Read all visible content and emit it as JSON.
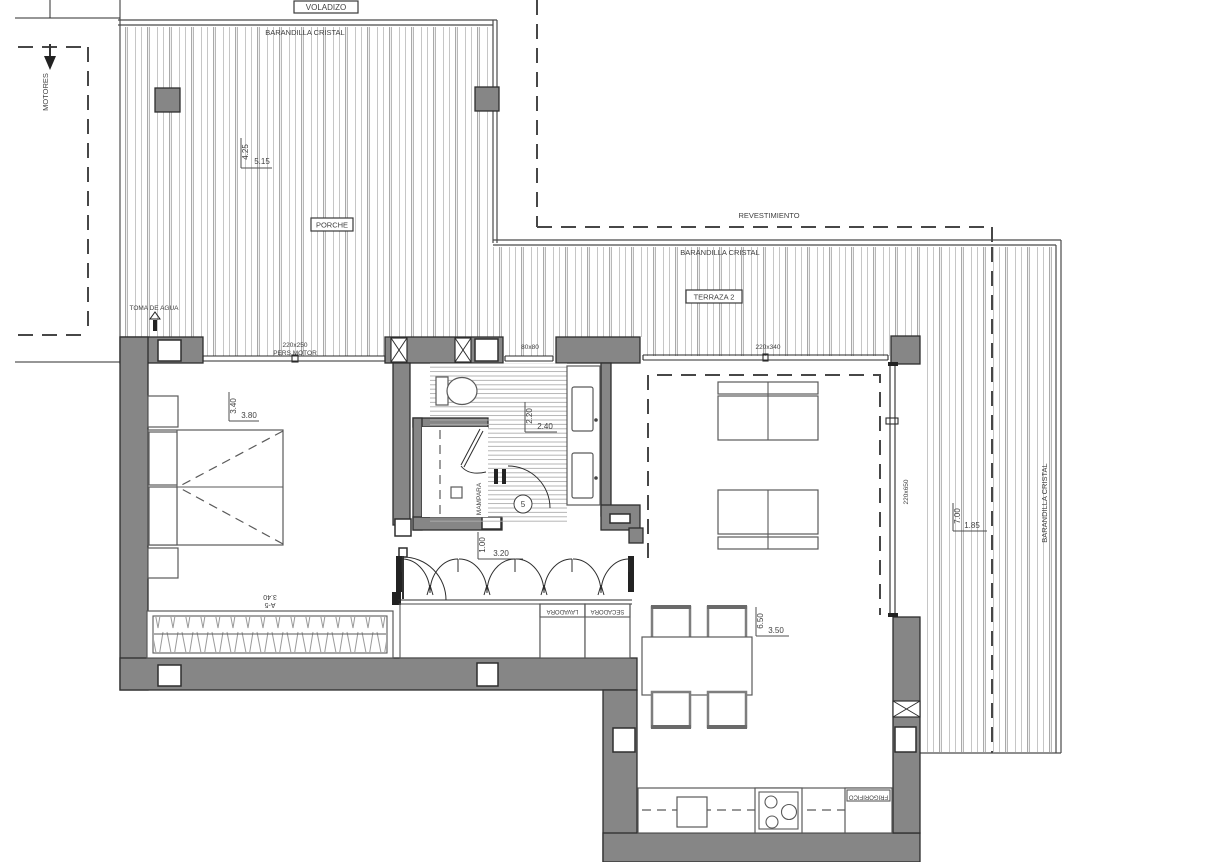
{
  "plan": {
    "labels": {
      "voladizo": "VOLADIZO",
      "barandilla_top": "BARANDILLA CRISTAL",
      "motores": "MOTORES",
      "porche": "PORCHE",
      "revestimiento": "REVESTIMIENTO",
      "barandilla_terraza": "BARANDILLA CRISTAL",
      "terraza2": "TERRAZA 2",
      "toma_de_agua": "TOMA DE AGUA",
      "win_bedroom_size": "220x250",
      "win_bedroom_type": "PERS.MOTOR",
      "win_bath": "80x80",
      "win_living": "220x340",
      "win_east": "220x650",
      "mampara": "MAMPARA",
      "door_number": "5",
      "wardrobe_size": "3.40",
      "wardrobe_ref": "A-5",
      "lavadora": "LAVADORA",
      "secadora": "SECADORA",
      "barandilla_right": "BARANDILLA CRISTAL",
      "frigorifico": "FRIGORIFICO"
    },
    "dims": {
      "porch_v": "4.25",
      "porch_h": "5.15",
      "bedroom_v": "3.40",
      "bedroom_h": "3.80",
      "bath_v": "2.20",
      "bath_h": "2.40",
      "hall_v": "1.00",
      "hall_h": "3.20",
      "living_v": "6.50",
      "living_h": "3.50",
      "terrace_v": "7.00",
      "terrace_h": "1.85"
    },
    "colors": {
      "wall": "#868686",
      "outline": "#2e2e2e",
      "deck": "#c3c3c3",
      "text": "#3f3f3f"
    }
  }
}
